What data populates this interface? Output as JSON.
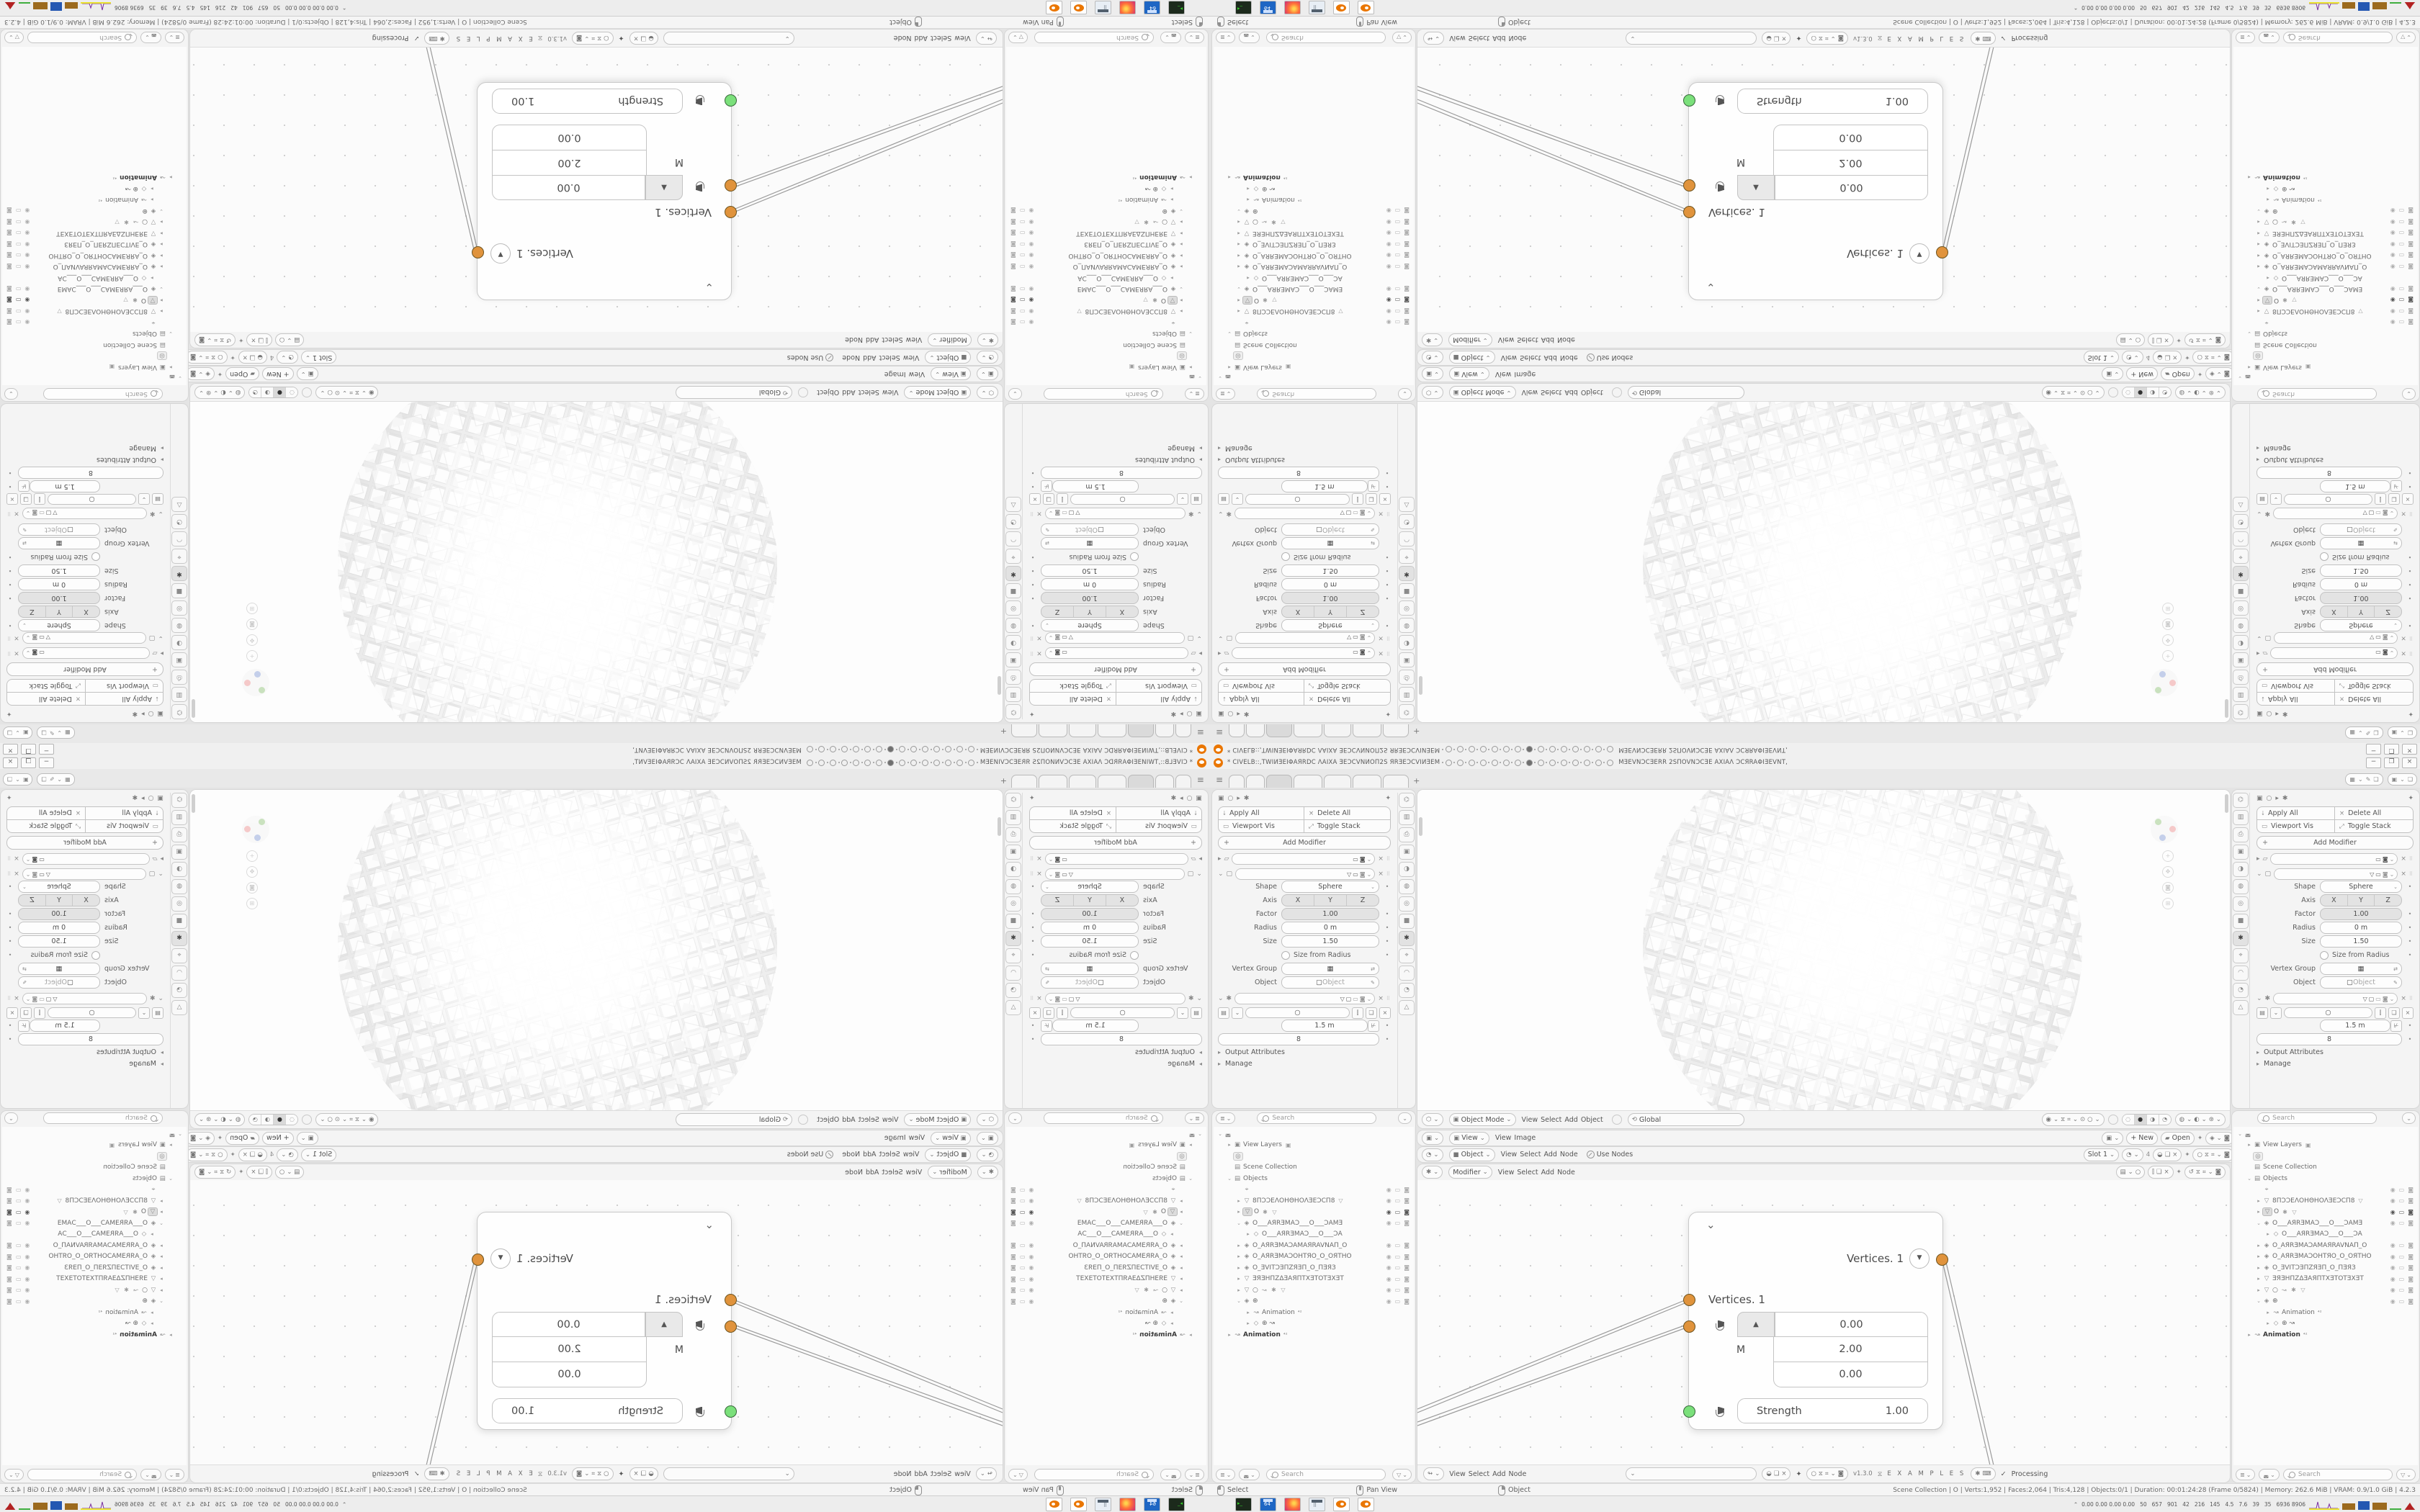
{
  "window": {
    "title_left": "* CIVELB::,TWIИƎEIΦAЯRDC ΛAIXA ƎEƆCVNИOП2S ЯRƎEƆCVIИƎEM",
    "title_right": "MƎEVNƆCƎERR 2SПOVNƆCƎE AXIAΛ ƆCЯRAΦIƎEVNT,",
    "circle_count": 15,
    "circle_active_index": 7,
    "minimize_label": "−",
    "restore_label": "❐",
    "close_label": "×"
  },
  "topbar": {
    "menu_icon": "≡",
    "tabs": [
      {
        "w": 20
      },
      {
        "w": 24
      },
      {
        "w": 34,
        "active": true
      },
      {
        "w": 38
      },
      {
        "w": 36
      },
      {
        "w": 38
      },
      {
        "w": 34
      }
    ],
    "new_tab_label": "+",
    "scene_icons": [
      "▦",
      "⌄",
      "✎",
      "❏"
    ],
    "viewlayer_icons": [
      "▣",
      "⌄",
      "❏"
    ]
  },
  "props": {
    "breadcrumb": [
      "▣",
      "○",
      "▸",
      "✱"
    ],
    "pin_icon": "✦",
    "actions": [
      {
        "icon": "⭣",
        "label": "Apply All"
      },
      {
        "icon": "×",
        "label": "Delete All"
      },
      {
        "icon": "▭",
        "label": "Viewport Vis"
      },
      {
        "icon": "⤢",
        "label": "Toggle Stack"
      }
    ],
    "add_plus": "+",
    "add_label": "Add Modifier",
    "mod_headers": [
      {
        "exp": "▸",
        "icon": "▱",
        "toggles": [
          "▭",
          "◙",
          "⌄"
        ],
        "close": "×",
        "grip": "⠿"
      },
      {
        "exp": "⌄",
        "icon": "▢",
        "toggles": [
          "▽",
          "▭",
          "◙",
          "⌄"
        ],
        "close": "×",
        "grip": "⠿"
      }
    ],
    "params": [
      {
        "type": "select",
        "label": "Shape",
        "value": "Sphere",
        "dot": true
      },
      {
        "type": "segment",
        "label": "Axis",
        "values": [
          "X",
          "Y",
          "Z"
        ],
        "dot": false
      },
      {
        "type": "slider",
        "label": "Factor",
        "value": "1.00",
        "dot": true
      },
      {
        "type": "value",
        "label": "Radius",
        "value": "0 m",
        "dot": true
      },
      {
        "type": "value",
        "label": "Size",
        "value": "1.50",
        "dot": true
      },
      {
        "type": "check",
        "label": "",
        "value": "Size from Radius",
        "dot": true
      },
      {
        "type": "vgroup",
        "label": "Vertex Group",
        "dot": false
      },
      {
        "type": "object",
        "label": "Object",
        "placeholder": "Object",
        "dot": false
      }
    ],
    "geo_header": {
      "exp": "⌄",
      "icon": "✱",
      "toggles": [
        "▽",
        "▢",
        "▭",
        "◙",
        "⌄"
      ],
      "close": "×",
      "grip": "⠿"
    },
    "nodegroup_icons": [
      "▤",
      "⌄",
      "○",
      "⫿",
      "❏",
      "×"
    ],
    "length_value": "1.5 m",
    "count_value": "8",
    "sections": [
      "Output Attributes",
      "Manage"
    ],
    "tabs": [
      {
        "g": "⌬"
      },
      {
        "g": "▥"
      },
      {
        "g": "⎙"
      },
      {
        "g": "▣"
      },
      {
        "g": "◑"
      },
      {
        "g": "◍"
      },
      {
        "g": "◎"
      },
      {
        "g": "■"
      },
      {
        "g": "✱",
        "active": true
      },
      {
        "g": "⌖"
      },
      {
        "g": "◠"
      },
      {
        "g": "◔"
      },
      {
        "g": "△"
      }
    ]
  },
  "outliner": {
    "search_placeholder": "Search",
    "rows": [
      {
        "i": 0,
        "exp": "⌄",
        "icon": "◛",
        "name": ""
      },
      {
        "i": 1,
        "exp": "▸",
        "icon": "▣",
        "name": "View Layers",
        "after": "▣"
      },
      {
        "i": 1,
        "exp": "",
        "icon": "◎",
        "name": "",
        "boxed": true
      },
      {
        "i": 1,
        "exp": "",
        "icon": "▤",
        "name": "Scene Collection"
      },
      {
        "i": 1,
        "exp": "⌄",
        "icon": "▤",
        "name": "Objects"
      },
      {
        "i": 2,
        "exp": "",
        "icon": "⌖",
        "name": "",
        "tg": 1
      },
      {
        "i": 2,
        "exp": "▸",
        "icon": "▽",
        "name": "8ПƆƆEΛOHΘHOΛƎEƆCП8",
        "after": "▽",
        "tg": 1
      },
      {
        "i": 2,
        "exp": "▸",
        "icon": "▽",
        "name": "O",
        "after": "✱ ▽",
        "tg": 2,
        "sel": true
      },
      {
        "i": 2,
        "exp": "⌄",
        "icon": "◈",
        "name": "O___AЯRƎMAƆ___O___ƆAMƎ",
        "tg": 1
      },
      {
        "i": 3,
        "exp": "▸",
        "icon": "◇",
        "name": "O___AЯRƎMAƆ___O___ƆA",
        "tg": 0
      },
      {
        "i": 2,
        "exp": "▸",
        "icon": "◈",
        "name": "O_AЯRƎMAƆAMAЯRAVNAП_O",
        "tg": 1
      },
      {
        "i": 2,
        "exp": "▸",
        "icon": "◈",
        "name": "O_AЯRƎMAƆOHTЯO_O_OЯTHO",
        "tg": 1
      },
      {
        "i": 2,
        "exp": "▸",
        "icon": "◈",
        "name": "O_ƎVITƆƎПZЯƎП_O_ПƎЯЗ",
        "tg": 1
      },
      {
        "i": 2,
        "exp": "▸",
        "icon": "▽",
        "name": "ƎЯƎHПZΔƎAЯПTXƎTOTƎXƎT",
        "tg": 1
      },
      {
        "i": 2,
        "exp": "▸",
        "icon": "▽",
        "name": "○",
        "after": "↝ ✱ ▽",
        "tg": 1
      },
      {
        "i": 2,
        "exp": "⌄",
        "icon": "◈",
        "name": "⊕",
        "tg": 1
      },
      {
        "i": 3,
        "exp": "▸",
        "icon": "↝",
        "name": "Animation",
        "badge": "⁴²"
      },
      {
        "i": 3,
        "exp": "▸",
        "icon": "◇",
        "name": "⊕  ↝"
      },
      {
        "i": 1,
        "exp": "▸",
        "icon": "↝",
        "name": "Animation",
        "badge": "⁴²",
        "bold": true
      }
    ]
  },
  "viewport": {
    "editor_icon": "⬡",
    "mode_value": "Object Mode",
    "menus": [
      "View",
      "Select",
      "Add",
      "Object"
    ],
    "orientation_icon": "⟲",
    "orientation_value": "Global",
    "snap_icons": [
      "◉",
      "⌄",
      "⧖",
      "⌗",
      "⌄",
      "⊙",
      "○",
      "⌄"
    ],
    "shade_modes": [
      "◌",
      "●",
      "◑",
      "◔"
    ],
    "overlay_icons": [
      "◍",
      "⌄",
      "◐",
      "⌄",
      "⊛",
      "⌄"
    ]
  },
  "editors": {
    "image": {
      "icon": "▣",
      "selector": "View",
      "menus": [
        "View",
        "Image"
      ],
      "new_label": "+ New",
      "open_icon": "▰",
      "open_label": "Open",
      "pin": "✦",
      "right_icons": [
        "◈",
        "⌄",
        "◙"
      ]
    },
    "shader": {
      "icon": "◔",
      "selector": "Object",
      "menus": [
        "View",
        "Select",
        "Add",
        "Node"
      ],
      "use_nodes": "Use Nodes",
      "slot": "Slot 1",
      "count": "4",
      "tools": [
        "◒",
        "❏",
        "×"
      ],
      "pin": "✦",
      "right_icons": [
        "○",
        "⧖",
        "⌗",
        "⌄",
        "◙"
      ]
    },
    "geo": {
      "icon": "✱",
      "selector": "Modifier",
      "menus": [
        "View",
        "Select",
        "Add",
        "Node"
      ],
      "group_icons": [
        "▤",
        "⌄",
        "○"
      ],
      "tools": [
        "⫿",
        "❏",
        "×"
      ],
      "pin": "✦",
      "right_icons": [
        "↺",
        "⧖",
        "⌗",
        "⌄",
        "◙"
      ]
    }
  },
  "node": {
    "collapse_icon": "⌄",
    "output_label": "Vertices. 1",
    "output_menu_icon": "▼",
    "input_label": "Vertices. 1",
    "up_icon": "▲",
    "matrix_label": "M",
    "vector_values": [
      "0.00",
      "2.00",
      "0.00"
    ],
    "strength_label": "Strength",
    "strength_value": "1.00"
  },
  "node_footer": {
    "icon": "↬",
    "menus": [
      "View",
      "Select",
      "Add",
      "Node"
    ],
    "field_icons": [
      "◒",
      "❏",
      "×"
    ],
    "pin": "✦",
    "right_icons": [
      "○",
      "⧖",
      "⌗",
      "⌄",
      "◙"
    ],
    "version": "v1.3.0",
    "dna_icon": "⧖",
    "examples_label": "E X A M P L E S",
    "check_icon": "✓",
    "processing_label": "Processing"
  },
  "statusbar": {
    "hints": [
      {
        "btn": "ml",
        "label": "Select"
      },
      {
        "btn": "mm",
        "label": "Pan View"
      },
      {
        "btn": "mr",
        "label": "Object"
      }
    ],
    "stats": "Scene Collection | O | Verts:1,952 | Faces:2,064 | Tris:4,128 | Objects:0/1 | Duration: 00:01:24:28 (Frame 0/5824) | Memory: 262.6 MiB | VRAM: 0.9/1.0 GiB | 4.2.3"
  },
  "taskbar": {
    "apps": [
      "terminal",
      "floppy64",
      "firefox",
      "calculator",
      "blender",
      "blender"
    ],
    "tray_caret": "⌃",
    "tray_values": [
      "0.00 0.00 0.00 0.00",
      "50",
      "657",
      "901",
      "42",
      "216",
      "145",
      "4.5",
      "7.6",
      "39",
      "35",
      "6936 8906"
    ]
  },
  "colors": {
    "logo_orange": "#ea7600",
    "socket_orange": "#e0933c",
    "socket_green": "#7be07b",
    "graph_yellow": "#e8e12a",
    "graph_purple": "#7a2ea0",
    "graph_brown": "#9c6a1e",
    "graph_blue": "#2457b2",
    "graph_green": "#3fae3f",
    "graph_red": "#b22222"
  }
}
